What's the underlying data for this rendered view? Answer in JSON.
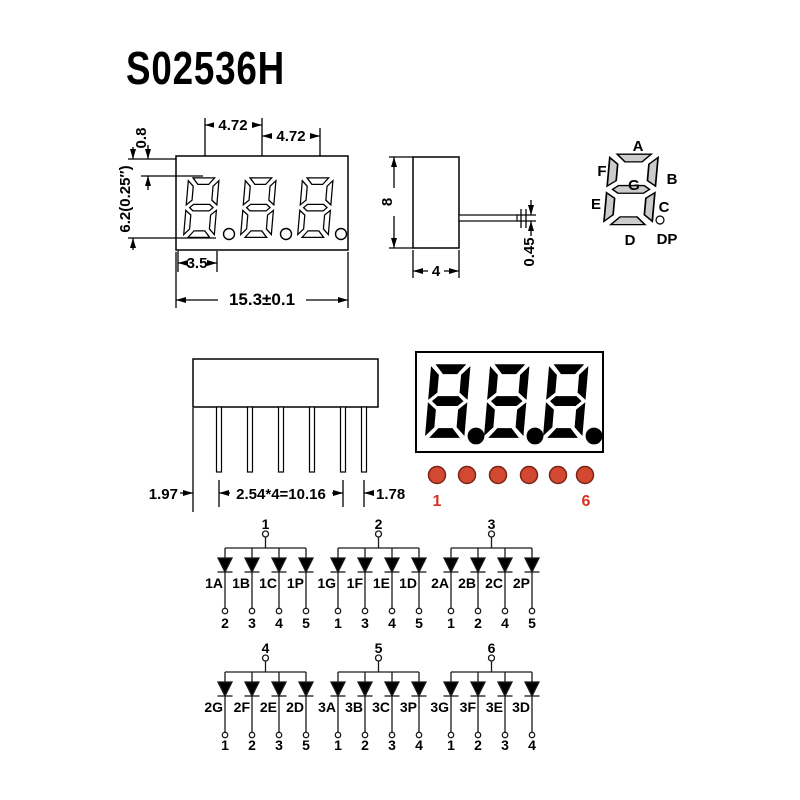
{
  "title": "S02536H",
  "front_view": {
    "pitch1": "4.72",
    "pitch2": "4.72",
    "top_gap": "0.8",
    "digit_height": "6.2(0.25″)",
    "digit_width": "3.5",
    "total_width": "15.3±0.1"
  },
  "side_view": {
    "height": "8",
    "depth": "4",
    "pin_thickness": "0.45"
  },
  "segment_diagram": {
    "a": "A",
    "b": "B",
    "c": "C",
    "d": "D",
    "e": "E",
    "f": "F",
    "g": "G",
    "dp": "DP"
  },
  "pin_view": {
    "left_offset": "1.97",
    "pitch": "2.54*4=10.16",
    "right_offset": "1.78"
  },
  "display_face": {
    "first_pin": "1",
    "last_pin": "6"
  },
  "colors": {
    "led_red": "#d34831",
    "led_red_border": "#7a2418",
    "red_text": "#d43425"
  },
  "schematic": {
    "groups": [
      {
        "common": "1",
        "diodes": [
          "1A",
          "1B",
          "1C",
          "1P"
        ],
        "pins": [
          "2",
          "3",
          "4",
          "5"
        ]
      },
      {
        "common": "2",
        "diodes": [
          "1G",
          "1F",
          "1E",
          "1D"
        ],
        "pins": [
          "1",
          "3",
          "4",
          "5"
        ]
      },
      {
        "common": "3",
        "diodes": [
          "2A",
          "2B",
          "2C",
          "2P"
        ],
        "pins": [
          "1",
          "2",
          "4",
          "5"
        ]
      },
      {
        "common": "4",
        "diodes": [
          "2G",
          "2F",
          "2E",
          "2D"
        ],
        "pins": [
          "1",
          "2",
          "3",
          "5"
        ]
      },
      {
        "common": "5",
        "diodes": [
          "3A",
          "3B",
          "3C",
          "3P"
        ],
        "pins": [
          "1",
          "2",
          "3",
          "4"
        ]
      },
      {
        "common": "6",
        "diodes": [
          "3G",
          "3F",
          "3E",
          "3D"
        ],
        "pins": [
          "1",
          "2",
          "3",
          "4"
        ]
      }
    ]
  }
}
